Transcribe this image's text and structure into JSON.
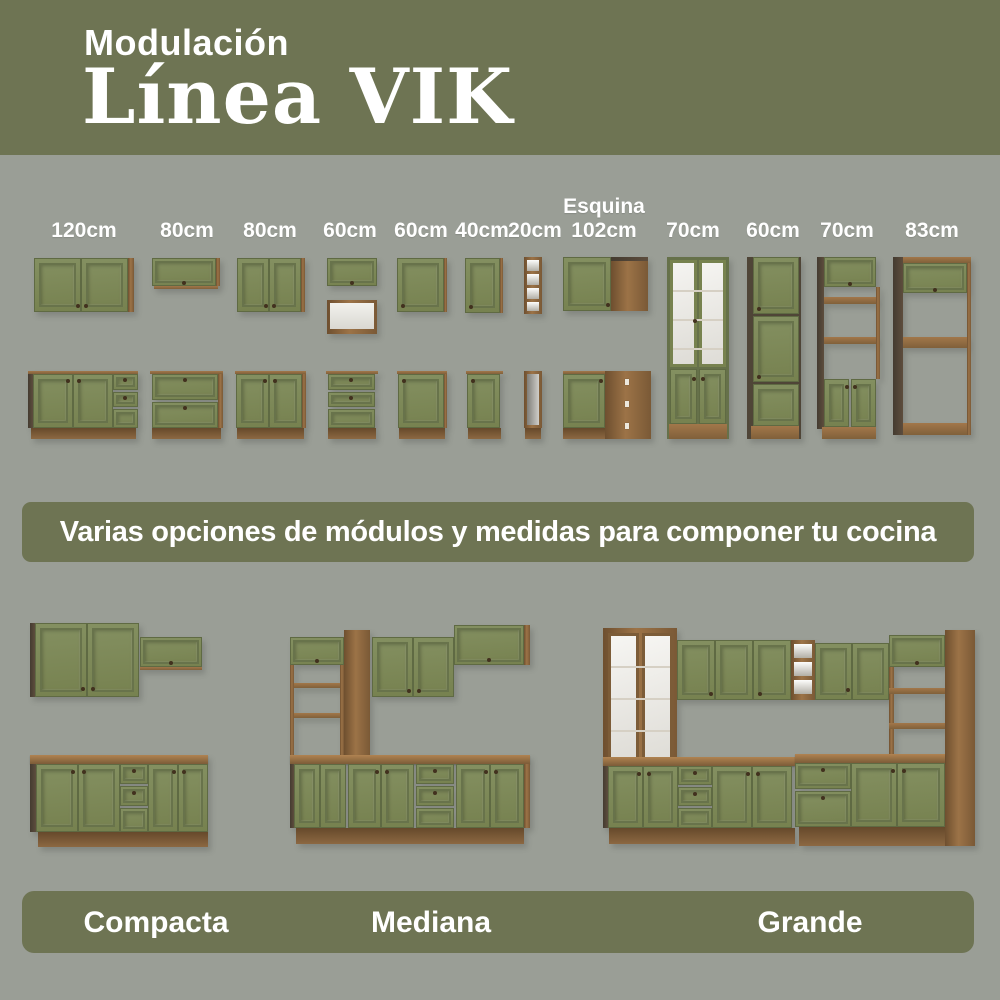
{
  "header": {
    "eyebrow": "Modulación",
    "title": "Línea VIK"
  },
  "modules": {
    "items": [
      {
        "label": "120cm"
      },
      {
        "label": "80cm"
      },
      {
        "label": "80cm"
      },
      {
        "label": "60cm"
      },
      {
        "label": "60cm"
      },
      {
        "label": "40cm"
      },
      {
        "label": "20cm"
      },
      {
        "toplabel": "Esquina",
        "label": "102cm"
      },
      {
        "label": "70cm"
      },
      {
        "label": "60cm"
      },
      {
        "label": "70cm"
      },
      {
        "label": "83cm"
      }
    ]
  },
  "banner": {
    "text": "Varias opciones de módulos y medidas para componer tu cocina"
  },
  "kitchens": {
    "items": [
      {
        "label": "Compacta"
      },
      {
        "label": "Mediana"
      },
      {
        "label": "Grande"
      }
    ]
  },
  "colors": {
    "header_bg": "#6E7453",
    "page_bg": "#9A9E96",
    "cabinet_green": "#7B8657",
    "wood_brown": "#8A6238",
    "dark_wood": "#4A4136",
    "interior_white": "#F2F1ED",
    "text_white": "#FFFFFF"
  }
}
